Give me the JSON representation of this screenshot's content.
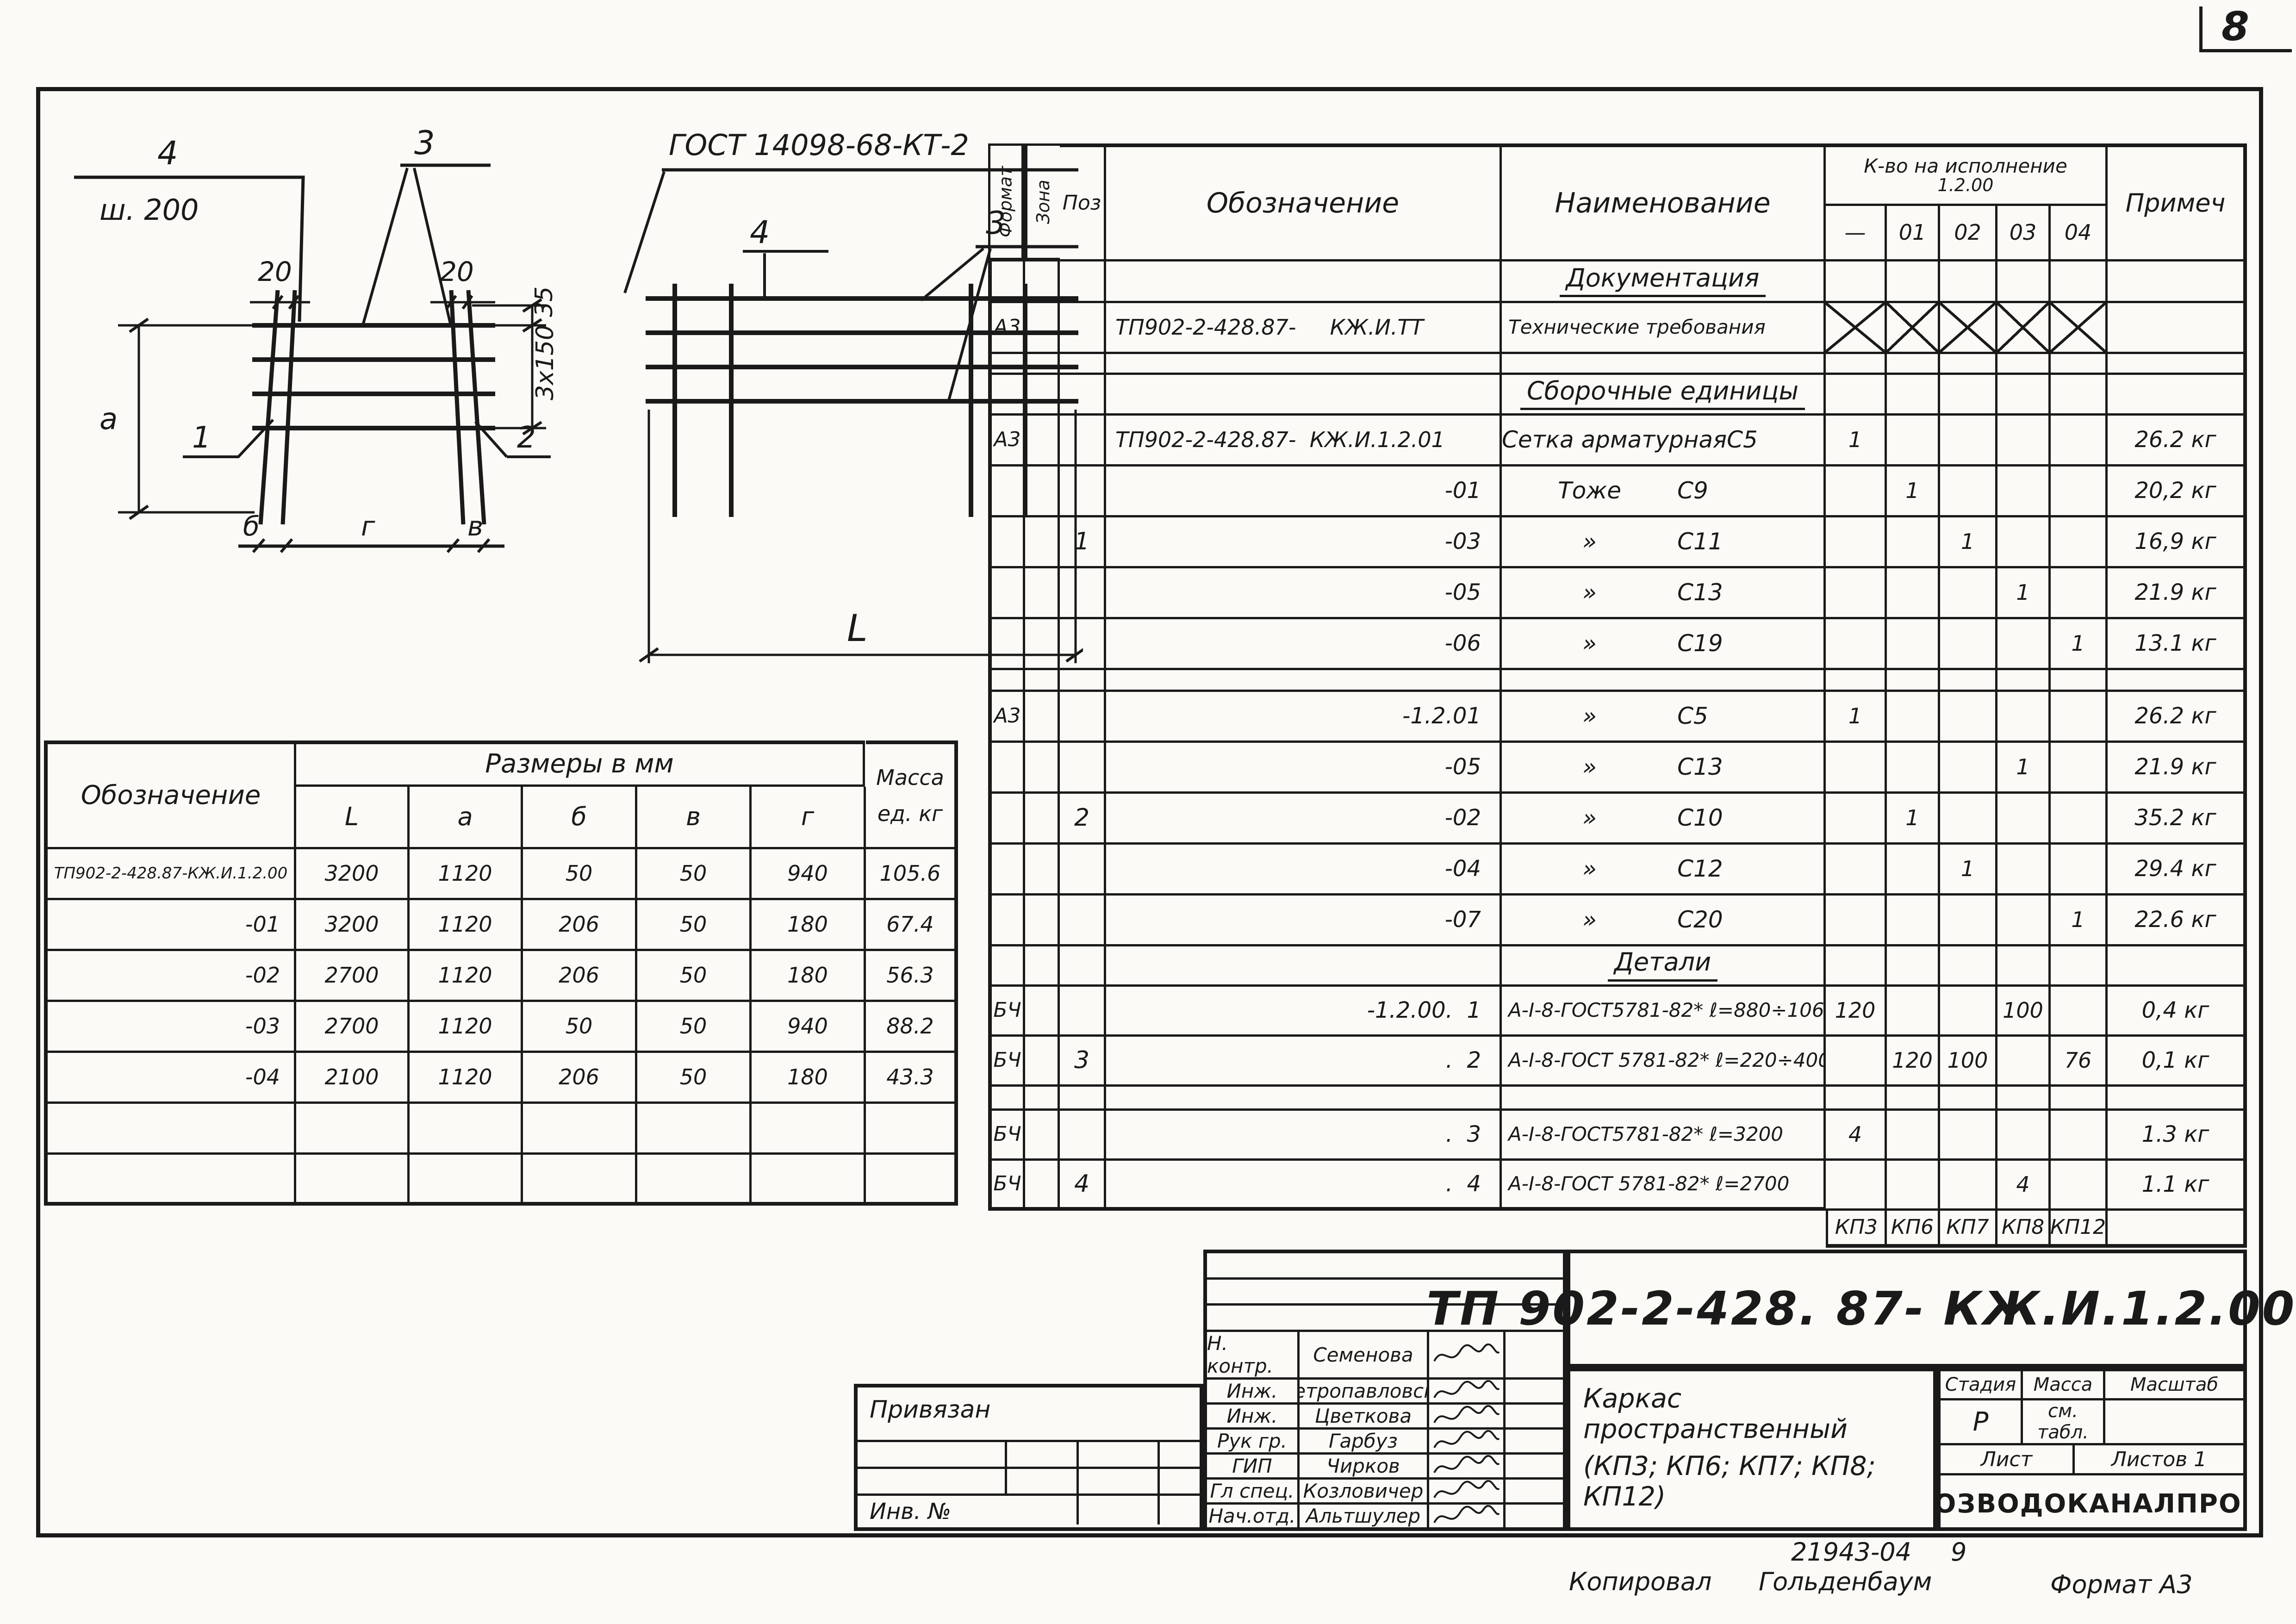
{
  "page": {
    "number": "8"
  },
  "footer": {
    "doc_ref": "21943-04",
    "sheet_ref": "9",
    "copied_label": "Копировал",
    "copied_name": "Гольденбаум",
    "format_note": "Формат А3"
  },
  "sketch_left": {
    "pos4": "4",
    "pitch": "ш. 200",
    "pos3": "3",
    "dim20a": "20",
    "dim20b": "20",
    "dim35": "35",
    "dim3x150": "3x150",
    "dim_height": "а",
    "callout1": "1",
    "callout2": "2",
    "dim_b": "б",
    "dim_g": "г",
    "dim_v": "в"
  },
  "sketch_right": {
    "gost": "ГОСТ 14098-68-КТ-2",
    "pos4": "4",
    "pos3": "3",
    "dim_length": "L"
  },
  "dims_table": {
    "col_designation": "Обозначение",
    "group_header": "Размеры в мм",
    "size_cols": [
      "L",
      "а",
      "б",
      "в",
      "г"
    ],
    "mass_header_1": "Масса",
    "mass_header_2": "ед. кг",
    "rows": [
      {
        "designation": "ТП902-2-428.87-КЖ.И.1.2.00",
        "l": "3200",
        "a": "1120",
        "b": "50",
        "v": "50",
        "g": "940",
        "mass": "105.6"
      },
      {
        "designation": "-01",
        "l": "3200",
        "a": "1120",
        "b": "206",
        "v": "50",
        "g": "180",
        "mass": "67.4"
      },
      {
        "designation": "-02",
        "l": "2700",
        "a": "1120",
        "b": "206",
        "v": "50",
        "g": "180",
        "mass": "56.3"
      },
      {
        "designation": "-03",
        "l": "2700",
        "a": "1120",
        "b": "50",
        "v": "50",
        "g": "940",
        "mass": "88.2"
      },
      {
        "designation": "-04",
        "l": "2100",
        "a": "1120",
        "b": "206",
        "v": "50",
        "g": "180",
        "mass": "43.3"
      },
      {
        "designation": "",
        "l": "",
        "a": "",
        "b": "",
        "v": "",
        "g": "",
        "mass": ""
      },
      {
        "designation": "",
        "l": "",
        "a": "",
        "b": "",
        "v": "",
        "g": "",
        "mass": ""
      }
    ]
  },
  "spec_table": {
    "headers": {
      "format": "Формат",
      "zone": "Зона",
      "pos": "Поз",
      "designation": "Обозначение",
      "name": "Наименование",
      "qty_group": "К-во на исполнение",
      "qty_sub": "1.2.00",
      "qty_cols": [
        "—",
        "01",
        "02",
        "03",
        "04"
      ],
      "note": "Примеч"
    },
    "rows": [
      {
        "kind": "section",
        "text": "Документация"
      },
      {
        "kind": "item",
        "format": "А3",
        "designation": "ТП902-2-428.87-     КЖ.И.ТТ",
        "name": "Технические требования",
        "x_row": true,
        "note": ""
      },
      {
        "kind": "spacer"
      },
      {
        "kind": "section",
        "text": "Сборочные единицы"
      },
      {
        "kind": "item",
        "format": "А3",
        "designation": "ТП902-2-428.87-  КЖ.И.1.2.01",
        "name_l": "Сетка арматурная",
        "name_r": "С5",
        "qty": [
          "1",
          "",
          "",
          "",
          ""
        ],
        "note": "26.2 кг"
      },
      {
        "kind": "item",
        "designation": "-01",
        "name_l": "Тоже",
        "name_r": "С9",
        "qty": [
          "",
          "1",
          "",
          "",
          ""
        ],
        "note": "20,2 кг"
      },
      {
        "kind": "item",
        "pos": "1",
        "designation": "-03",
        "name_l": "»",
        "name_r": "С11",
        "qty": [
          "",
          "",
          "1",
          "",
          ""
        ],
        "note": "16,9 кг"
      },
      {
        "kind": "item",
        "designation": "-05",
        "name_l": "»",
        "name_r": "С13",
        "qty": [
          "",
          "",
          "",
          "1",
          ""
        ],
        "note": "21.9 кг"
      },
      {
        "kind": "item",
        "designation": "-06",
        "name_l": "»",
        "name_r": "С19",
        "qty": [
          "",
          "",
          "",
          "",
          "1"
        ],
        "note": "13.1 кг"
      },
      {
        "kind": "spacer"
      },
      {
        "kind": "item",
        "format": "А3",
        "designation": "-1.2.01",
        "name_l": "»",
        "name_r": "С5",
        "qty": [
          "1",
          "",
          "",
          "",
          ""
        ],
        "note": "26.2 кг"
      },
      {
        "kind": "item",
        "designation": "-05",
        "name_l": "»",
        "name_r": "С13",
        "qty": [
          "",
          "",
          "",
          "1",
          ""
        ],
        "note": "21.9 кг"
      },
      {
        "kind": "item",
        "pos": "2",
        "designation": "-02",
        "name_l": "»",
        "name_r": "С10",
        "qty": [
          "",
          "1",
          "",
          "",
          ""
        ],
        "note": "35.2 кг"
      },
      {
        "kind": "item",
        "designation": "-04",
        "name_l": "»",
        "name_r": "С12",
        "qty": [
          "",
          "",
          "1",
          "",
          ""
        ],
        "note": "29.4 кг"
      },
      {
        "kind": "item",
        "designation": "-07",
        "name_l": "»",
        "name_r": "С20",
        "qty": [
          "",
          "",
          "",
          "",
          "1"
        ],
        "note": "22.6 кг"
      },
      {
        "kind": "section",
        "text": "Детали"
      },
      {
        "kind": "item",
        "format": "БЧ",
        "designation": "-1.2.00.  1",
        "name": "А-I-8-ГОСТ5781-82* ℓ=880÷1060",
        "qty": [
          "120",
          "",
          "",
          "100",
          ""
        ],
        "note": "0,4 кг"
      },
      {
        "kind": "item",
        "pos": "3",
        "format": "БЧ",
        "designation": ".  2",
        "name": "А-I-8-ГОСТ 5781-82* ℓ=220÷400",
        "qty": [
          "",
          "120",
          "100",
          "",
          "76"
        ],
        "note": "0,1 кг"
      },
      {
        "kind": "spacer"
      },
      {
        "kind": "item",
        "format": "БЧ",
        "designation": ".  3",
        "name": "А-I-8-ГОСТ5781-82* ℓ=3200",
        "qty": [
          "4",
          "",
          "",
          "",
          ""
        ],
        "note": "1.3 кг"
      },
      {
        "kind": "item",
        "pos": "4",
        "format": "БЧ",
        "designation": ".  4",
        "name": "А-I-8-ГОСТ 5781-82* ℓ=2700",
        "qty": [
          "",
          "",
          "",
          "4",
          ""
        ],
        "note": "1.1 кг"
      }
    ],
    "kp_labels": [
      "КП3",
      "КП6",
      "КП7",
      "КП8",
      "КП12"
    ]
  },
  "title_block": {
    "doc_number": "ТП 902-2-428. 87- КЖ.И.1.2.00 СБ",
    "title_line1": "Каркас пространственный",
    "title_line2": "(КП3; КП6; КП7; КП8; КП12)",
    "stage_label": "Стадия",
    "mass_label": "Масса",
    "scale_label": "Масштаб",
    "stage_value": "Р",
    "mass_value_1": "см.",
    "mass_value_2": "табл.",
    "scale_value": "",
    "sheet_label": "Лист",
    "sheets_label": "Листов 1",
    "organization": "СОЮЗВОДОКАНАЛПРОЕКТ",
    "signatures": [
      {
        "role": "Н. контр.",
        "name": "Семенова"
      },
      {
        "role": "Инж.",
        "name": "Петропавловска"
      },
      {
        "role": "Инж.",
        "name": "Цветкова"
      },
      {
        "role": "Рук гр.",
        "name": "Гарбуз"
      },
      {
        "role": "ГИП",
        "name": "Чирков"
      },
      {
        "role": "Гл спец.",
        "name": "Козловичер"
      },
      {
        "role": "Нач.отд.",
        "name": "Альтшулер"
      }
    ],
    "binding_label": "Привязан",
    "inventory_label": "Инв. №"
  }
}
